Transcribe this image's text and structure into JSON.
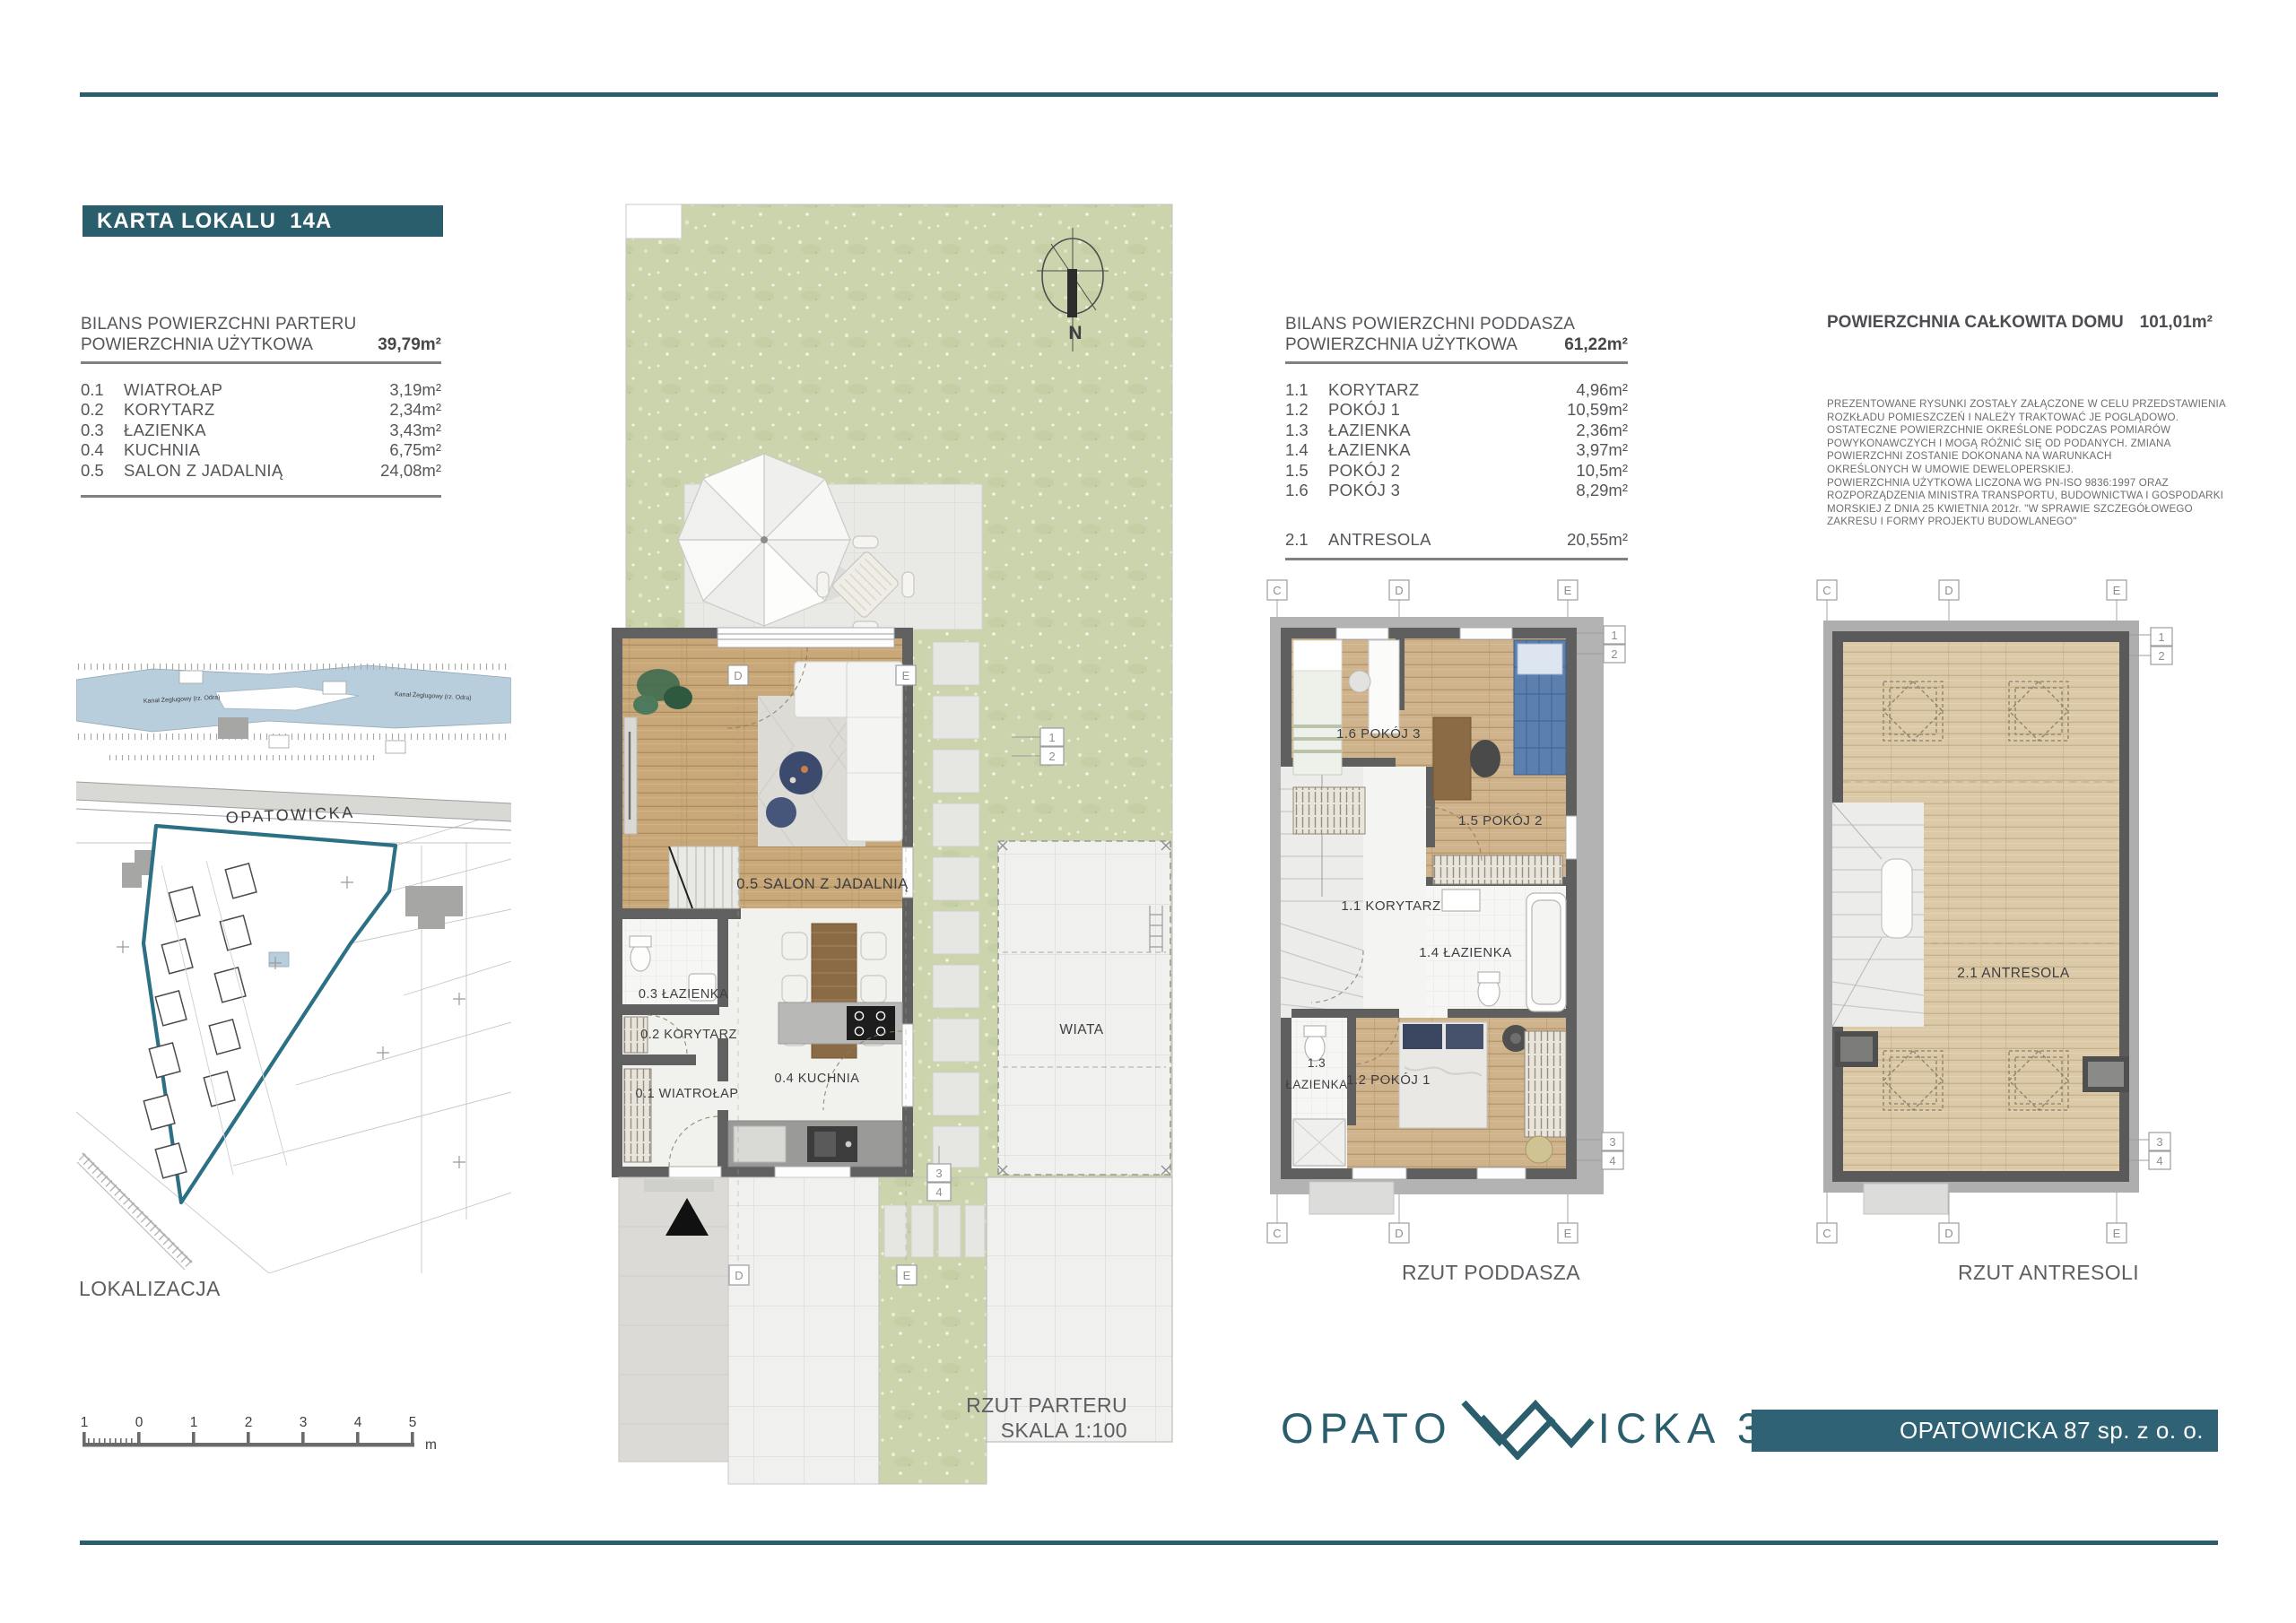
{
  "header": {
    "title_box": "KARTA LOKALU  14A"
  },
  "parter_table": {
    "title": "BILANS POWIERZCHNI PARTERU",
    "subtitle": "POWIERZCHNIA UŻYTKOWA",
    "total": "39,79m²",
    "rows": [
      {
        "no": "0.1",
        "name": "WIATROŁAP",
        "area": "3,19m²"
      },
      {
        "no": "0.2",
        "name": "KORYTARZ",
        "area": "2,34m²"
      },
      {
        "no": "0.3",
        "name": "ŁAZIENKA",
        "area": "3,43m²"
      },
      {
        "no": "0.4",
        "name": "KUCHNIA",
        "area": "6,75m²"
      },
      {
        "no": "0.5",
        "name": "SALON  Z  JADALNIĄ",
        "area": "24,08m²"
      }
    ]
  },
  "poddasze_table": {
    "title": "BILANS POWIERZCHNI PODDASZA",
    "subtitle": "POWIERZCHNIA UŻYTKOWA",
    "total": "61,22m²",
    "rows": [
      {
        "no": "1.1",
        "name": "KORYTARZ",
        "area": "4,96m²"
      },
      {
        "no": "1.2",
        "name": "POKÓJ 1",
        "area": "10,59m²"
      },
      {
        "no": "1.3",
        "name": "ŁAZIENKA",
        "area": "2,36m²"
      },
      {
        "no": "1.4",
        "name": "ŁAZIENKA",
        "area": "3,97m²"
      },
      {
        "no": "1.5",
        "name": "POKÓJ 2",
        "area": "10,5m²"
      },
      {
        "no": "1.6",
        "name": "POKÓJ 3",
        "area": "8,29m²"
      }
    ],
    "extra_row": {
      "no": "2.1",
      "name": "ANTRESOLA",
      "area": "20,55m²"
    }
  },
  "total_area": {
    "label": "POWIERZCHNIA CAŁKOWITA DOMU",
    "value": "101,01m²"
  },
  "disclaimer": "PREZENTOWANE RYSUNKI ZOSTAŁY ZAŁĄCZONE W  CELU PRZEDSTAWIENIA\nROZKŁADU POMIESZCZEŃ  I NALEŻY TRAKTOWAĆ JE POGLĄDOWO.\nOSTATECZNE POWIERZCHNIE OKREŚLONE PODCZAS POMIARÓW\nPOWYKONAWCZYCH I MOGĄ RÓŻNIĆ SIĘ OD PODANYCH. ZMIANA\nPOWIERZCHNI ZOSTANIE DOKONANA NA WARUNKACH\nOKREŚLONYCH W UMOWIE DEWELOPERSKIEJ.\nPOWIERZCHNIA UŻYTKOWA LICZONA WG PN-ISO 9836:1997 ORAZ\nROZPORZĄDZENIA MINISTRA TRANSPORTU, BUDOWNICTWA I GOSPODARKI\nMORSKIEJ Z DNIA 25 KWIETNIA 2012r. \"W SPRAWIE SZCZEGÓŁOWEGO\nZAKRESU I FORMY PROJEKTU BUDOWLANEGO\"",
  "plans": {
    "parter": {
      "caption_line1": "RZUT PARTERU",
      "caption_line2": "SKALA 1:100",
      "rooms": {
        "salon": "0.5 SALON  Z JADALNIĄ",
        "lazienka": "0.3 ŁAZIENKA",
        "korytarz": "0.2 KORYTARZ",
        "wiatrolap": "0.1 WIATROŁAP",
        "kuchnia": "0.4 KUCHNIA"
      },
      "wiata": "WIATA",
      "compass_n": "N"
    },
    "poddasze": {
      "caption": "RZUT PODDASZA",
      "rooms": {
        "pokoj3": "1.6  POKÓJ 3",
        "pokoj2": "1.5  POKÓJ 2",
        "korytarz": "1.1  KORYTARZ",
        "lazienka14": "1.4  ŁAZIENKA",
        "lazienka13_l1": "1.3",
        "lazienka13_l2": "ŁAZIENKA",
        "pokoj1": "1.2  POKÓJ 1"
      }
    },
    "antresola": {
      "caption": "RZUT ANTRESOLI",
      "room": "2.1  ANTRESOLA"
    }
  },
  "grid": {
    "c": "C",
    "d": "D",
    "e": "E",
    "n1": "1",
    "n2": "2",
    "n3": "3",
    "n4": "4"
  },
  "map": {
    "caption": "LOKALIZACJA",
    "street": "OPATOWICKA",
    "canal_label": "Kanał Żeglugowy (rz. Odra)"
  },
  "scalebar": {
    "ticks": [
      "1",
      "0",
      "1",
      "2",
      "3",
      "4",
      "5"
    ],
    "unit": "m"
  },
  "footer": {
    "logo_left": "OPATO",
    "logo_right": "ICKA 3.0",
    "company": "OPATOWICKA 87 sp. z o. o."
  },
  "colors": {
    "teal": "#2b5e6d",
    "plot_outline": "#2b7084",
    "lawn": "#cbd4ad"
  }
}
